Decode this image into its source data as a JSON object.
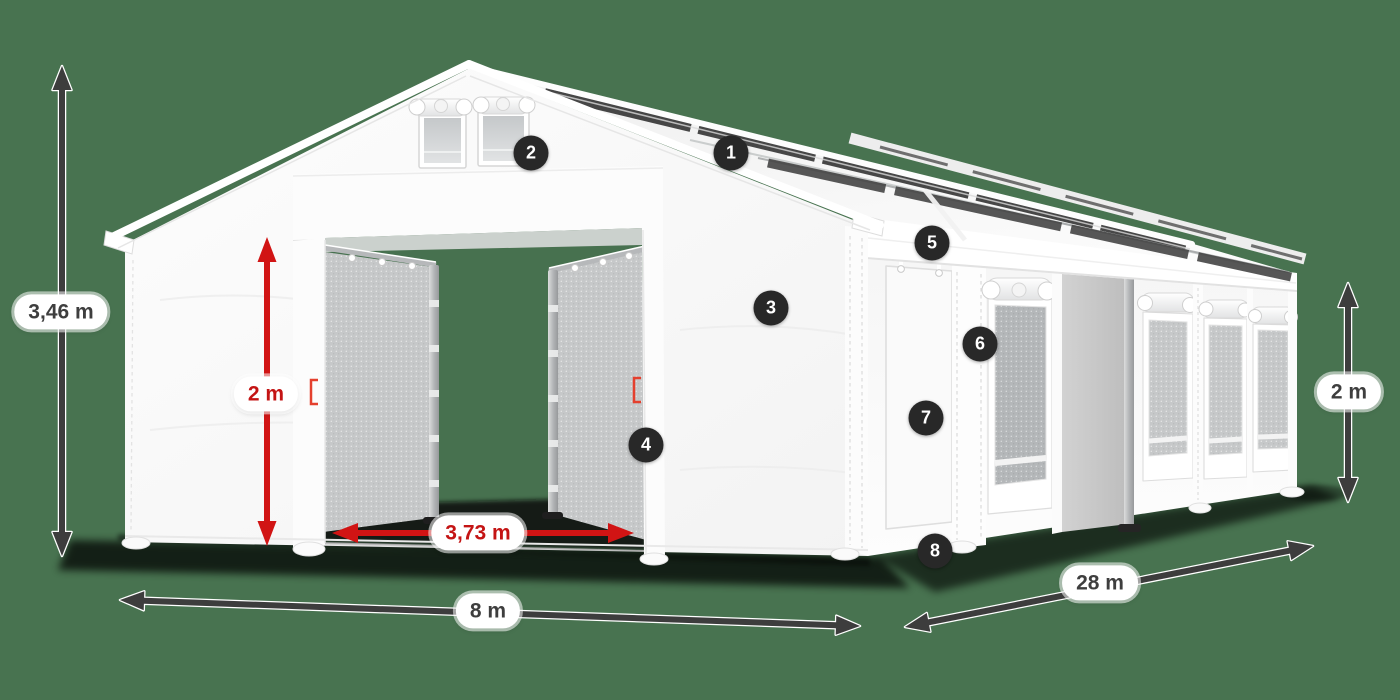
{
  "scene": {
    "description": "White storage tent / marquee product diagram with dimension arrows and numbered feature callouts",
    "background_color": "#487350"
  },
  "colors": {
    "background": "#487350",
    "badge": "#282828",
    "arrow_dark": "#3d3d3d",
    "arrow_red": "#d11414",
    "label_dark_text": "#3e3e3e",
    "label_red_text": "#c41414",
    "tent_white": "#fafafa",
    "mesh_gray": "#c0c3c5",
    "roof_band_dark": "#3b3b3b"
  },
  "dimensions": [
    {
      "id": "total-height",
      "text": "3,46 m",
      "style": "dark",
      "x": 61,
      "y": 312
    },
    {
      "id": "door-height",
      "text": "2 m",
      "style": "red",
      "x": 266,
      "y": 394
    },
    {
      "id": "door-width",
      "text": "3,73 m",
      "style": "red",
      "x": 478,
      "y": 533
    },
    {
      "id": "tent-width",
      "text": "8 m",
      "style": "dark",
      "x": 488,
      "y": 611
    },
    {
      "id": "tent-length",
      "text": "28 m",
      "style": "dark",
      "x": 1100,
      "y": 583
    },
    {
      "id": "side-height",
      "text": "2 m",
      "style": "dark",
      "x": 1349,
      "y": 392
    }
  ],
  "callouts": [
    {
      "number": "1",
      "x": 731,
      "y": 153
    },
    {
      "number": "2",
      "x": 531,
      "y": 153
    },
    {
      "number": "3",
      "x": 771,
      "y": 308
    },
    {
      "number": "4",
      "x": 646,
      "y": 445
    },
    {
      "number": "5",
      "x": 932,
      "y": 243
    },
    {
      "number": "6",
      "x": 980,
      "y": 344
    },
    {
      "number": "7",
      "x": 926,
      "y": 418
    },
    {
      "number": "8",
      "x": 935,
      "y": 551
    }
  ]
}
